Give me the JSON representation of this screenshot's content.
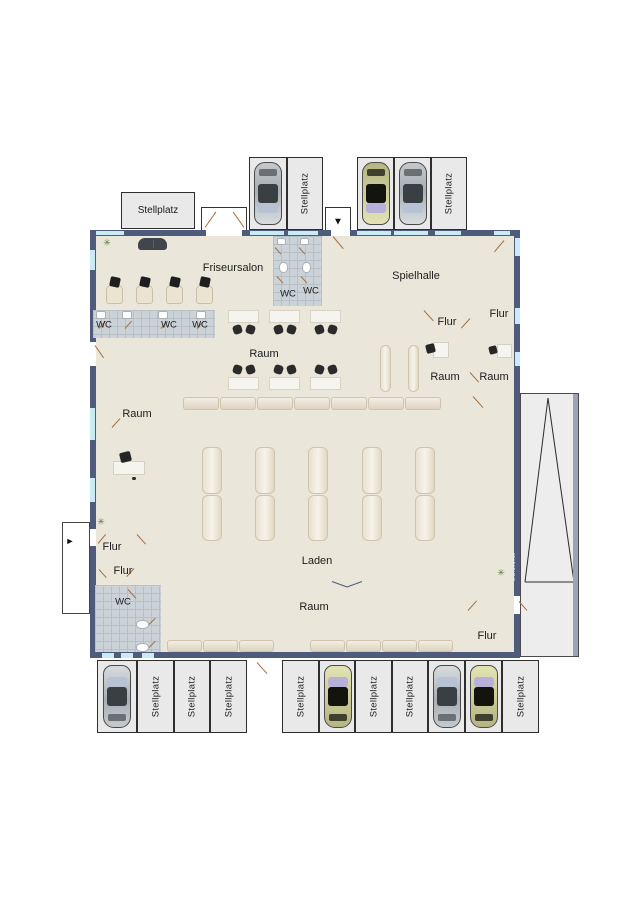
{
  "plan": {
    "rooms": {
      "friseursalon": "Friseursalon",
      "spielhalle": "Spielhalle",
      "laden": "Laden",
      "raum": "Raum",
      "flur": "Flur",
      "wc": "WC"
    },
    "parking": {
      "stellplatz_label": "Stellplatz",
      "top_spaces_total": 5,
      "top_cars": 3,
      "bottom_spaces_total": 11,
      "bottom_cars": 4
    },
    "annex_note": "o.Grundriss",
    "icons": {
      "entrance_down": "▼",
      "entrance_right": "►",
      "plant": "✳"
    },
    "colors": {
      "wall": "#4e5b7c",
      "floor": "#eae6da",
      "tile": "#ccd3d8",
      "window": "#c9ecf4",
      "door_swing": "#a3713f",
      "parking_fill": "#e9e9e9",
      "car_silver": "#aab0b5",
      "car_olive": "#c9c98f"
    }
  }
}
